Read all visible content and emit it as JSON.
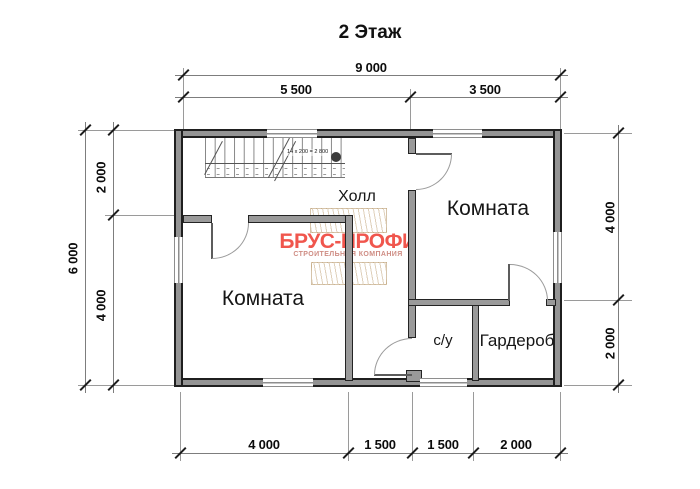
{
  "title": "2 Этаж",
  "rooms": {
    "hall": "Холл",
    "room_right": "Комната",
    "room_left": "Комната",
    "bathroom": "с/у",
    "wardrobe": "Гардероб"
  },
  "stairs": {
    "annotation": "14 х 200 = 2 800"
  },
  "dimensions": {
    "top_total": "9 000",
    "top_left": "5 500",
    "top_right": "3 500",
    "left_total": "6 000",
    "left_top": "2 000",
    "left_bottom": "4 000",
    "right_top": "4 000",
    "right_bottom": "2 000",
    "bottom_1": "4 000",
    "bottom_2": "1 500",
    "bottom_3": "1 500",
    "bottom_4": "2 000"
  },
  "watermark": {
    "brand": "БРУС-ПРОФИ",
    "tagline": "СТРОИТЕЛЬНАЯ КОМПАНИЯ",
    "brand_color": "#f0564d",
    "tagline_color": "#cf8d84"
  }
}
